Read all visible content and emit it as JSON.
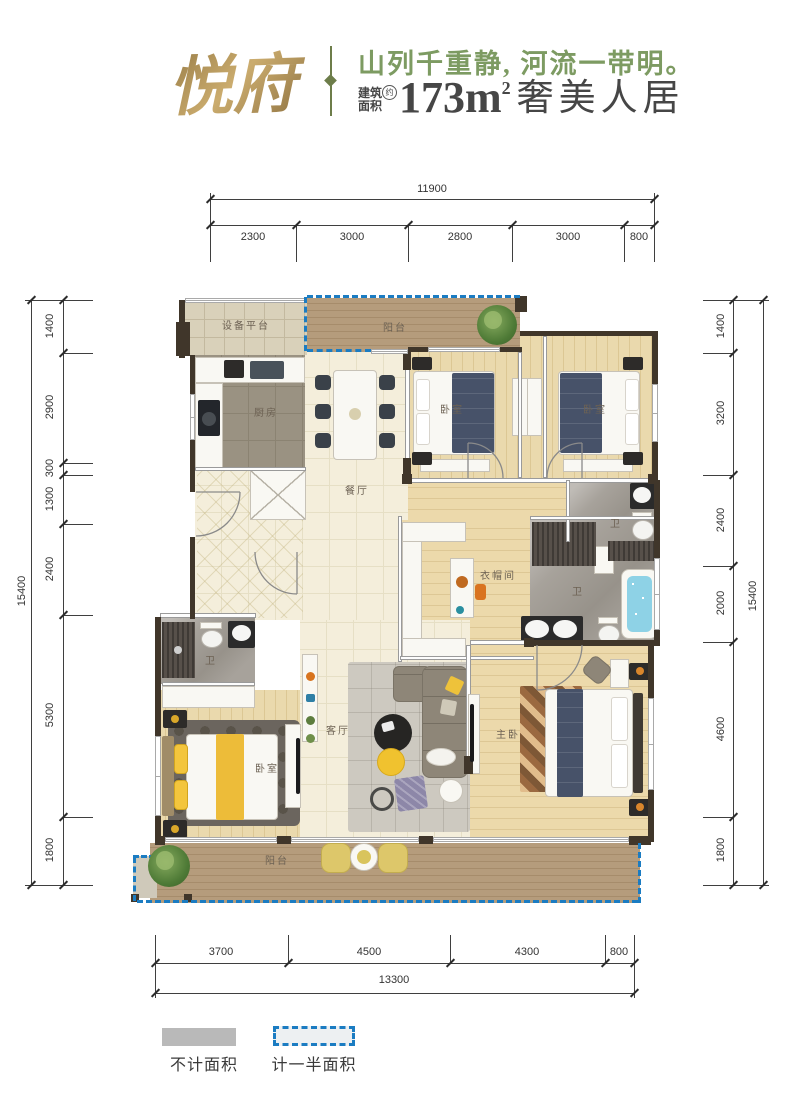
{
  "header": {
    "logo": "悦府",
    "tagline": "山列千重静, 河流一带明。",
    "area_label_line1": "建筑",
    "area_label_line2": "面积",
    "area_approx": "约",
    "area_value": "173m",
    "area_exponent": "2",
    "area_suffix": "奢美人居"
  },
  "dimensions": {
    "top": {
      "total": "11900",
      "segments": [
        "2300",
        "3000",
        "2800",
        "3000",
        "800"
      ]
    },
    "bottom": {
      "total": "13300",
      "segments": [
        "3700",
        "4500",
        "4300",
        "800"
      ]
    },
    "left": {
      "total": "15400",
      "segments": [
        "1400",
        "2900",
        "300",
        "1300",
        "2400",
        "5300",
        "1800"
      ]
    },
    "right": {
      "total": "15400",
      "segments": [
        "1400",
        "3200",
        "2400",
        "2000",
        "4600",
        "1800"
      ]
    }
  },
  "rooms": {
    "equipment_platform": "设备平台",
    "balcony_top": "阳台",
    "kitchen": "厨房",
    "dining_room": "餐厅",
    "bedroom_top_left": "卧室",
    "bedroom_top_right": "卧室",
    "bathroom_top": "卫",
    "walk_in_closet": "衣帽间",
    "bathroom_master": "卫",
    "bathroom_second": "卫",
    "bedroom_bottom_left": "卧室",
    "living_room": "客厅",
    "master_bedroom": "主卧",
    "balcony_bottom": "阳台"
  },
  "legend": {
    "not_counted": "不计面积",
    "half_counted": "计一半面积"
  },
  "colors": {
    "accent_blue": "#1b7cc2",
    "logo_gold": "#b4945a",
    "tagline_green": "#7d9b62",
    "legend_gray": "#b9b9b9"
  }
}
